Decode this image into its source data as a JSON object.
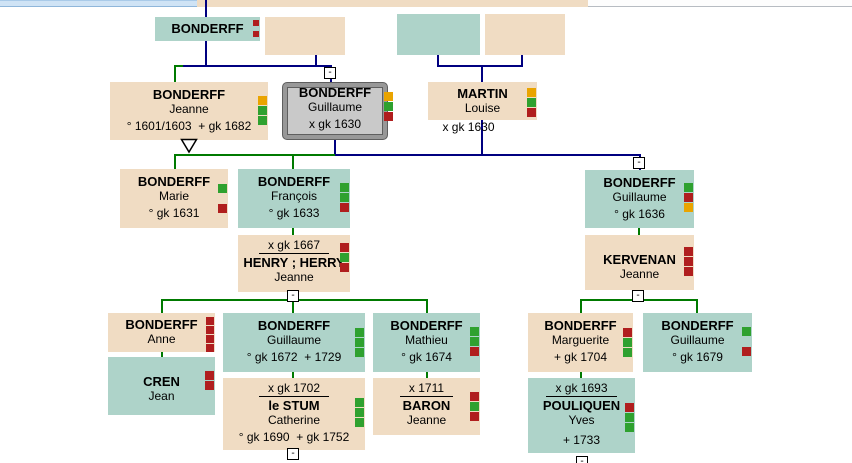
{
  "view": {
    "chart_label": "family-tree"
  },
  "glyphs": {
    "collapse": "-"
  },
  "colors": {
    "male_box": "#aed3c9",
    "female_box": "#f0dcc3",
    "selected_box_fill": "#c9c9c9",
    "selected_box_border": "#989898",
    "descent_line": "#007a00",
    "lineage_line": "#000080",
    "flag_red": "#b01e1e",
    "flag_green": "#2fa12f",
    "flag_yellow": "#eaa400",
    "top_strip_blue": "#cfe3f5",
    "top_strip_tan": "#f0dcc3"
  },
  "persons": {
    "top_bonderff": {
      "surname": "BONDERFF",
      "flags": [
        "red",
        "red"
      ]
    },
    "jeanne": {
      "surname": "BONDERFF",
      "given": "Jeanne",
      "detail": "° 1601/1603  + gk 1682",
      "flags": [
        "yellow",
        "green",
        "green"
      ]
    },
    "guillaume_sel": {
      "surname": "BONDERFF",
      "given": "Guillaume",
      "detail": "x gk 1630",
      "flags": [
        "yellow",
        "green",
        "red"
      ]
    },
    "martin": {
      "surname": "MARTIN",
      "given": "Louise",
      "below": "x gk 1630",
      "flags": [
        "yellow",
        "green",
        "red"
      ]
    },
    "marie": {
      "surname": "BONDERFF",
      "given": "Marie",
      "detail": "° gk 1631",
      "flags": [
        "green",
        "gap",
        "red"
      ]
    },
    "francois": {
      "surname": "BONDERFF",
      "given": "François",
      "detail": "° gk 1633",
      "flags": [
        "green",
        "green",
        "red"
      ]
    },
    "henry": {
      "mdate": "x gk 1667",
      "surname": "HENRY ; HERRY",
      "given": "Jeanne",
      "flags": [
        "red",
        "green",
        "red"
      ]
    },
    "guillaume1636": {
      "surname": "BONDERFF",
      "given": "Guillaume",
      "detail": "° gk 1636",
      "flags": [
        "green",
        "red",
        "yellow"
      ]
    },
    "kervenan": {
      "surname": "KERVENAN",
      "given": "Jeanne",
      "flags": [
        "red",
        "red",
        "red"
      ]
    },
    "anne": {
      "surname": "BONDERFF",
      "given": "Anne",
      "flags": [
        "red",
        "red",
        "red",
        "red"
      ]
    },
    "cren": {
      "surname": "CREN",
      "given": "Jean",
      "flags": [
        "red",
        "red"
      ]
    },
    "guillaume1672": {
      "surname": "BONDERFF",
      "given": "Guillaume",
      "detail": "° gk 1672  + 1729",
      "flags": [
        "green",
        "green",
        "green"
      ]
    },
    "lestum": {
      "mdate": "x gk 1702",
      "surname": "le STUM",
      "given": "Catherine",
      "detail": "° gk 1690  + gk 1752",
      "flags": [
        "green",
        "green",
        "green"
      ]
    },
    "mathieu": {
      "surname": "BONDERFF",
      "given": "Mathieu",
      "detail": "° gk 1674",
      "flags": [
        "green",
        "green",
        "red"
      ]
    },
    "baron": {
      "mdate": "x 1711",
      "surname": "BARON",
      "given": "Jeanne",
      "flags": [
        "red",
        "green",
        "red"
      ]
    },
    "marguerite": {
      "surname": "BONDERFF",
      "given": "Marguerite",
      "detail": "+ gk 1704",
      "flags": [
        "red",
        "green",
        "green"
      ]
    },
    "guillaume1679": {
      "surname": "BONDERFF",
      "given": "Guillaume",
      "detail": "° gk 1679",
      "flags": [
        "green",
        "gap",
        "red"
      ]
    },
    "pouliquen": {
      "mdate": "x gk 1693",
      "surname": "POULIQUEN",
      "given": "Yves",
      "detail": "+ 1733",
      "flags": [
        "red",
        "green",
        "green"
      ]
    }
  }
}
